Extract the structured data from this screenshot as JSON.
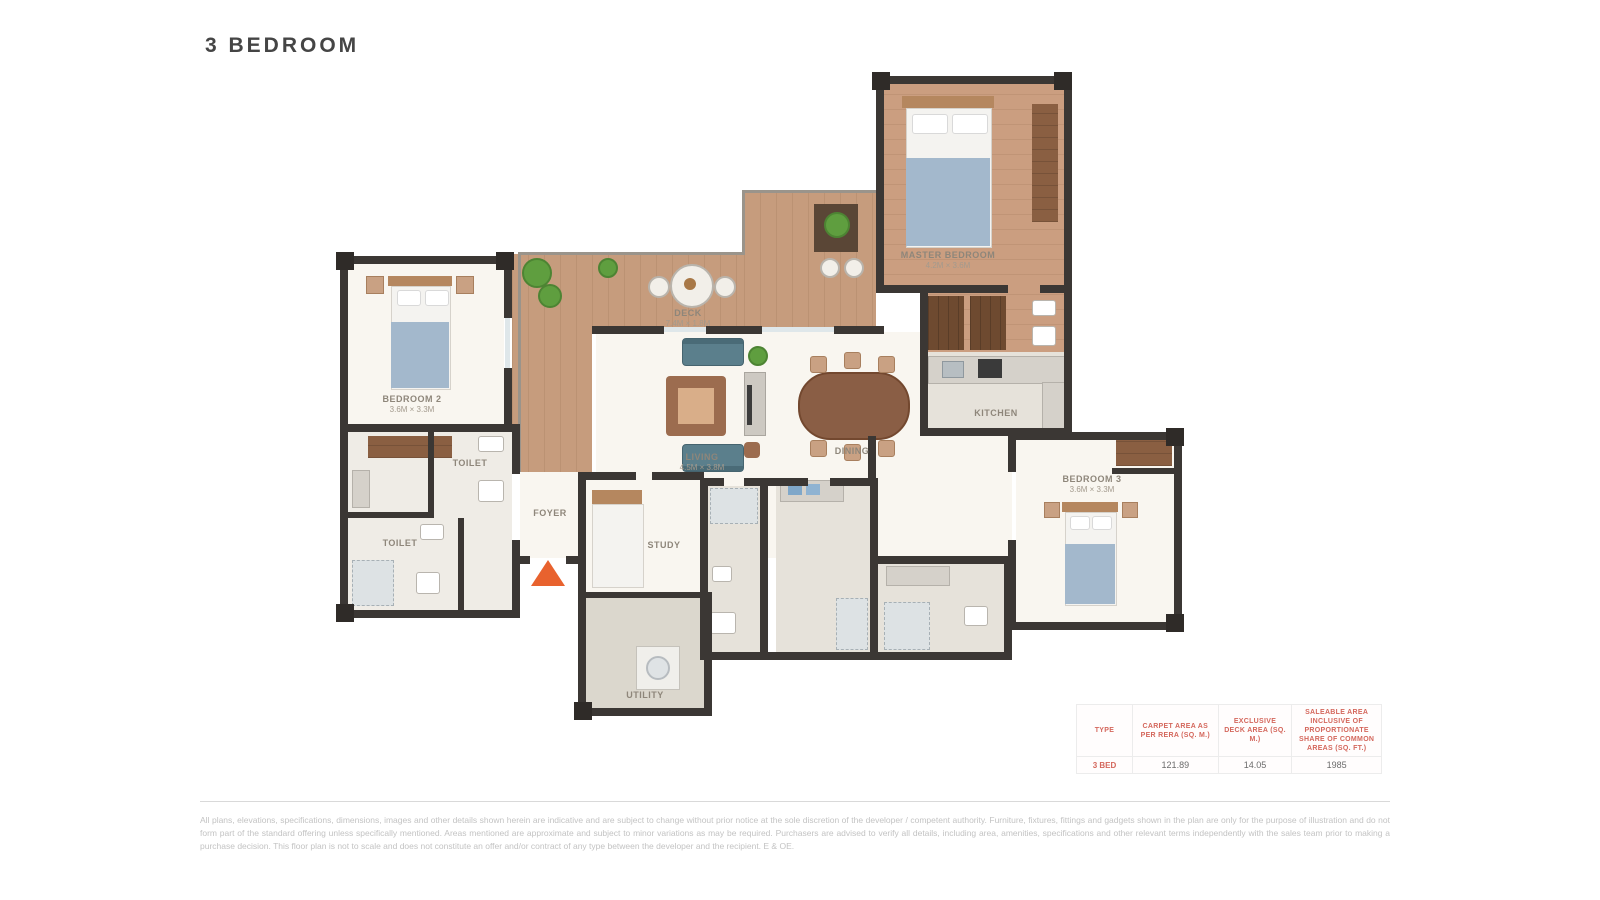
{
  "title": "3 BEDROOM",
  "plan": {
    "rooms": {
      "master": {
        "name": "MASTER BEDROOM",
        "dims": "4.2M × 3.6M"
      },
      "bedroom2": {
        "name": "BEDROOM 2",
        "dims": "3.6M × 3.3M"
      },
      "bedroom3": {
        "name": "BEDROOM 3",
        "dims": "3.6M × 3.3M"
      },
      "living": {
        "name": "LIVING",
        "dims": "4.5M × 3.8M"
      },
      "dining": {
        "name": "DINING",
        "dims": "3.2M × 2.8M"
      },
      "kitchen": {
        "name": "KITCHEN",
        "dims": "3.0M × 2.4M"
      },
      "deck": {
        "name": "DECK",
        "dims": "7.4M × 1.8M"
      },
      "foyer": {
        "name": "FOYER",
        "dims": ""
      },
      "study": {
        "name": "STUDY",
        "dims": "2.7M × 2.6M"
      },
      "utility": {
        "name": "UTILITY",
        "dims": "2.9M × 2.6M"
      },
      "toilet1": {
        "name": "TOILET",
        "dims": ""
      },
      "toilet2": {
        "name": "TOILET",
        "dims": ""
      }
    }
  },
  "area_table": {
    "columns": [
      "Type",
      "Carpet Area as per RERA (sq. m.)",
      "Exclusive Deck Area (sq. m.)",
      "Saleable Area inclusive of proportionate share of common areas (sq. ft.)"
    ],
    "row": {
      "type": "3 BED",
      "carpet": "121.89",
      "deck": "14.05",
      "saleable": "1985"
    }
  },
  "disclaimer": "All plans, elevations, specifications, dimensions, images and other details shown herein are indicative and are subject to change without prior notice at the sole discretion of the developer / competent authority. Furniture, fixtures, fittings and gadgets shown in the plan are only for the purpose of illustration and do not form part of the standard offering unless specifically mentioned. Areas mentioned are approximate and subject to minor variations as may be required. Purchasers are advised to verify all details, including area, amenities, specifications and other relevant terms independently with the sales team prior to making a purchase decision. This floor plan is not to scale and does not constitute an offer and/or contract of any type between the developer and the recipient. E & OE.",
  "colors": {
    "accent_red": "#d4675c",
    "wall": "#3b3734",
    "deck_wood": "#c69c7d",
    "entry_arrow": "#e8622e",
    "mattress_blue": "#a3b8cc",
    "sofa_teal": "#5b7f8c"
  }
}
